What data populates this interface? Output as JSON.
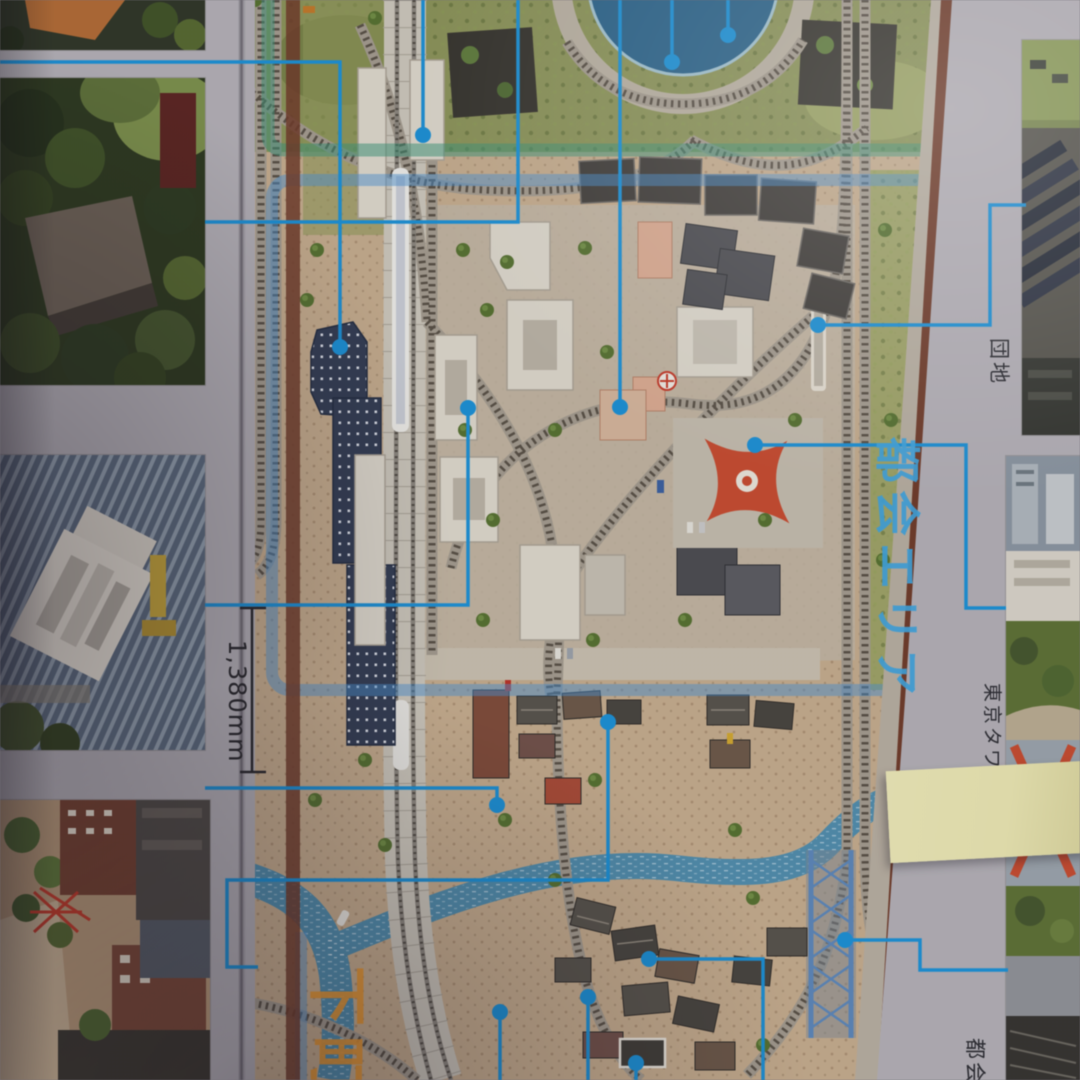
{
  "scene": "photographed catalog page of a model railway layout plan",
  "labels": {
    "urban_area_zone": "都会エリア",
    "downtown_zone": "下町",
    "danchi_callout": "団地",
    "tokyo_tower_callout": "東京タワー",
    "tokai_callout": "都会",
    "layout_width_dimension": "1,380mm"
  },
  "colors": {
    "urban_zone_label": "#3fa3dc",
    "downtown_label": "#e6952e",
    "leader_line": "#1a8fd4",
    "park_zone_border": "#3e9476",
    "urban_zone_border": "#4a90d2",
    "tokyo_tower_red": "#c64a2e",
    "river": "#4f8cab",
    "sticky_note": "#e9e5b0",
    "page_paper": "#b2afb5"
  }
}
